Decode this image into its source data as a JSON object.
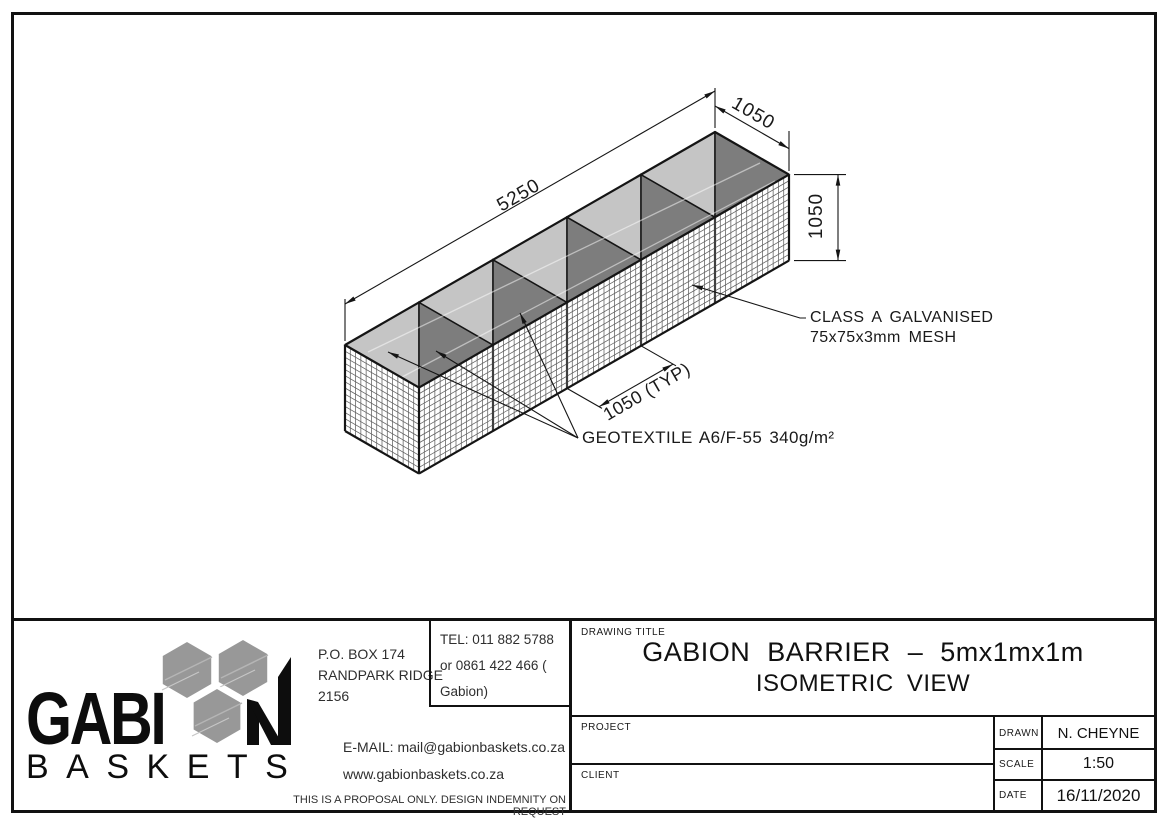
{
  "drawing": {
    "dimensions": {
      "length": "5250",
      "cell_width": "1050",
      "height": "1050",
      "cell_typ": "1050 (TYP)"
    },
    "notes": {
      "mesh_line1": "CLASS A GALVANISED",
      "mesh_line2": "75x75x3mm MESH",
      "geotextile": "GEOTEXTILE A6/F-55 340g/m²"
    },
    "colors": {
      "lid_light": "#c5c5c5",
      "lid_dark": "#7d7d7d",
      "edge": "#151515",
      "mesh": "#606060",
      "seam": "#3f3f3f",
      "hexagon": "#989898"
    }
  },
  "title_block": {
    "company": {
      "name_top_left": "GABI",
      "name_top_right": "N",
      "name_bottom": "BASKETS"
    },
    "address_lines": [
      "P.O. BOX 174",
      "RANDPARK RIDGE",
      "2156"
    ],
    "tel_lines": [
      "TEL: 011 882 5788",
      "or 0861 422 466 ( Gabion)"
    ],
    "email": "E-MAIL: mail@gabionbaskets.co.za",
    "website": "www.gabionbaskets.co.za",
    "disclaimer": "THIS IS A PROPOSAL ONLY. DESIGN INDEMNITY ON REQUEST",
    "drawing_title_label": "DRAWING TITLE",
    "drawing_title_line1": "GABION BARRIER – 5mx1mx1m",
    "drawing_title_line2": "ISOMETRIC VIEW",
    "project_label": "PROJECT",
    "project_value": "",
    "client_label": "CLIENT",
    "client_value": "",
    "meta": [
      {
        "label": "DRAWN",
        "value": "N. CHEYNE"
      },
      {
        "label": "SCALE",
        "value": "1:50"
      },
      {
        "label": "DATE",
        "value": "16/11/2020"
      }
    ]
  }
}
